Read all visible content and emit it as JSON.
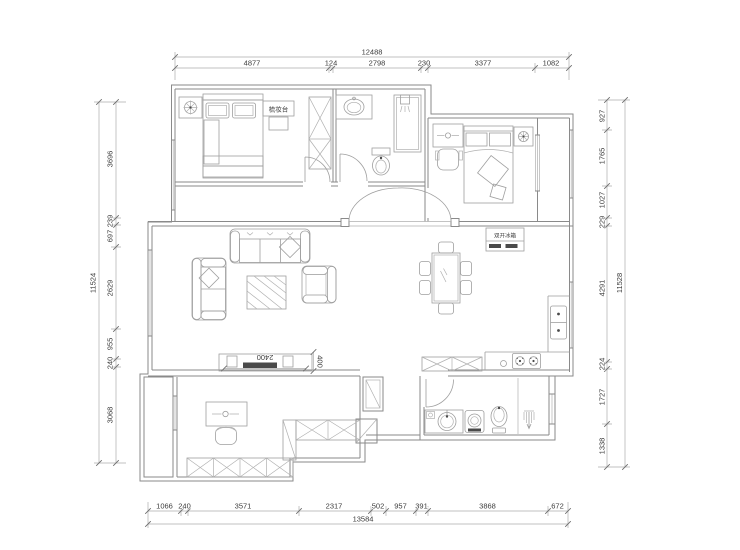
{
  "floor_plan": {
    "type": "residential floor plan (CAD line drawing)",
    "background": "#ffffff",
    "line_color": "#8a8a8a",
    "text_color": "#3c3c3c",
    "annotations": {
      "dressing_table_label": "梳妆台",
      "fridge_label": "双开冰箱",
      "tv_cabinet_width": "2400",
      "tv_cabinet_depth": "400"
    },
    "dimensions": {
      "top": {
        "total": "12488",
        "segments": [
          "4877",
          "124",
          "2798",
          "230",
          "3377",
          "1082"
        ]
      },
      "bottom": {
        "total": "13584",
        "segments": [
          "1066",
          "240",
          "3571",
          "2317",
          "502",
          "957",
          "391",
          "3868",
          "672"
        ]
      },
      "left": {
        "total": "11524",
        "segments": [
          "3696",
          "239",
          "697",
          "2629",
          "955",
          "240",
          "3068"
        ]
      },
      "right": {
        "total": "11528",
        "segments": [
          "927",
          "1765",
          "1027",
          "229",
          "4291",
          "224",
          "1727",
          "1338"
        ]
      }
    }
  }
}
